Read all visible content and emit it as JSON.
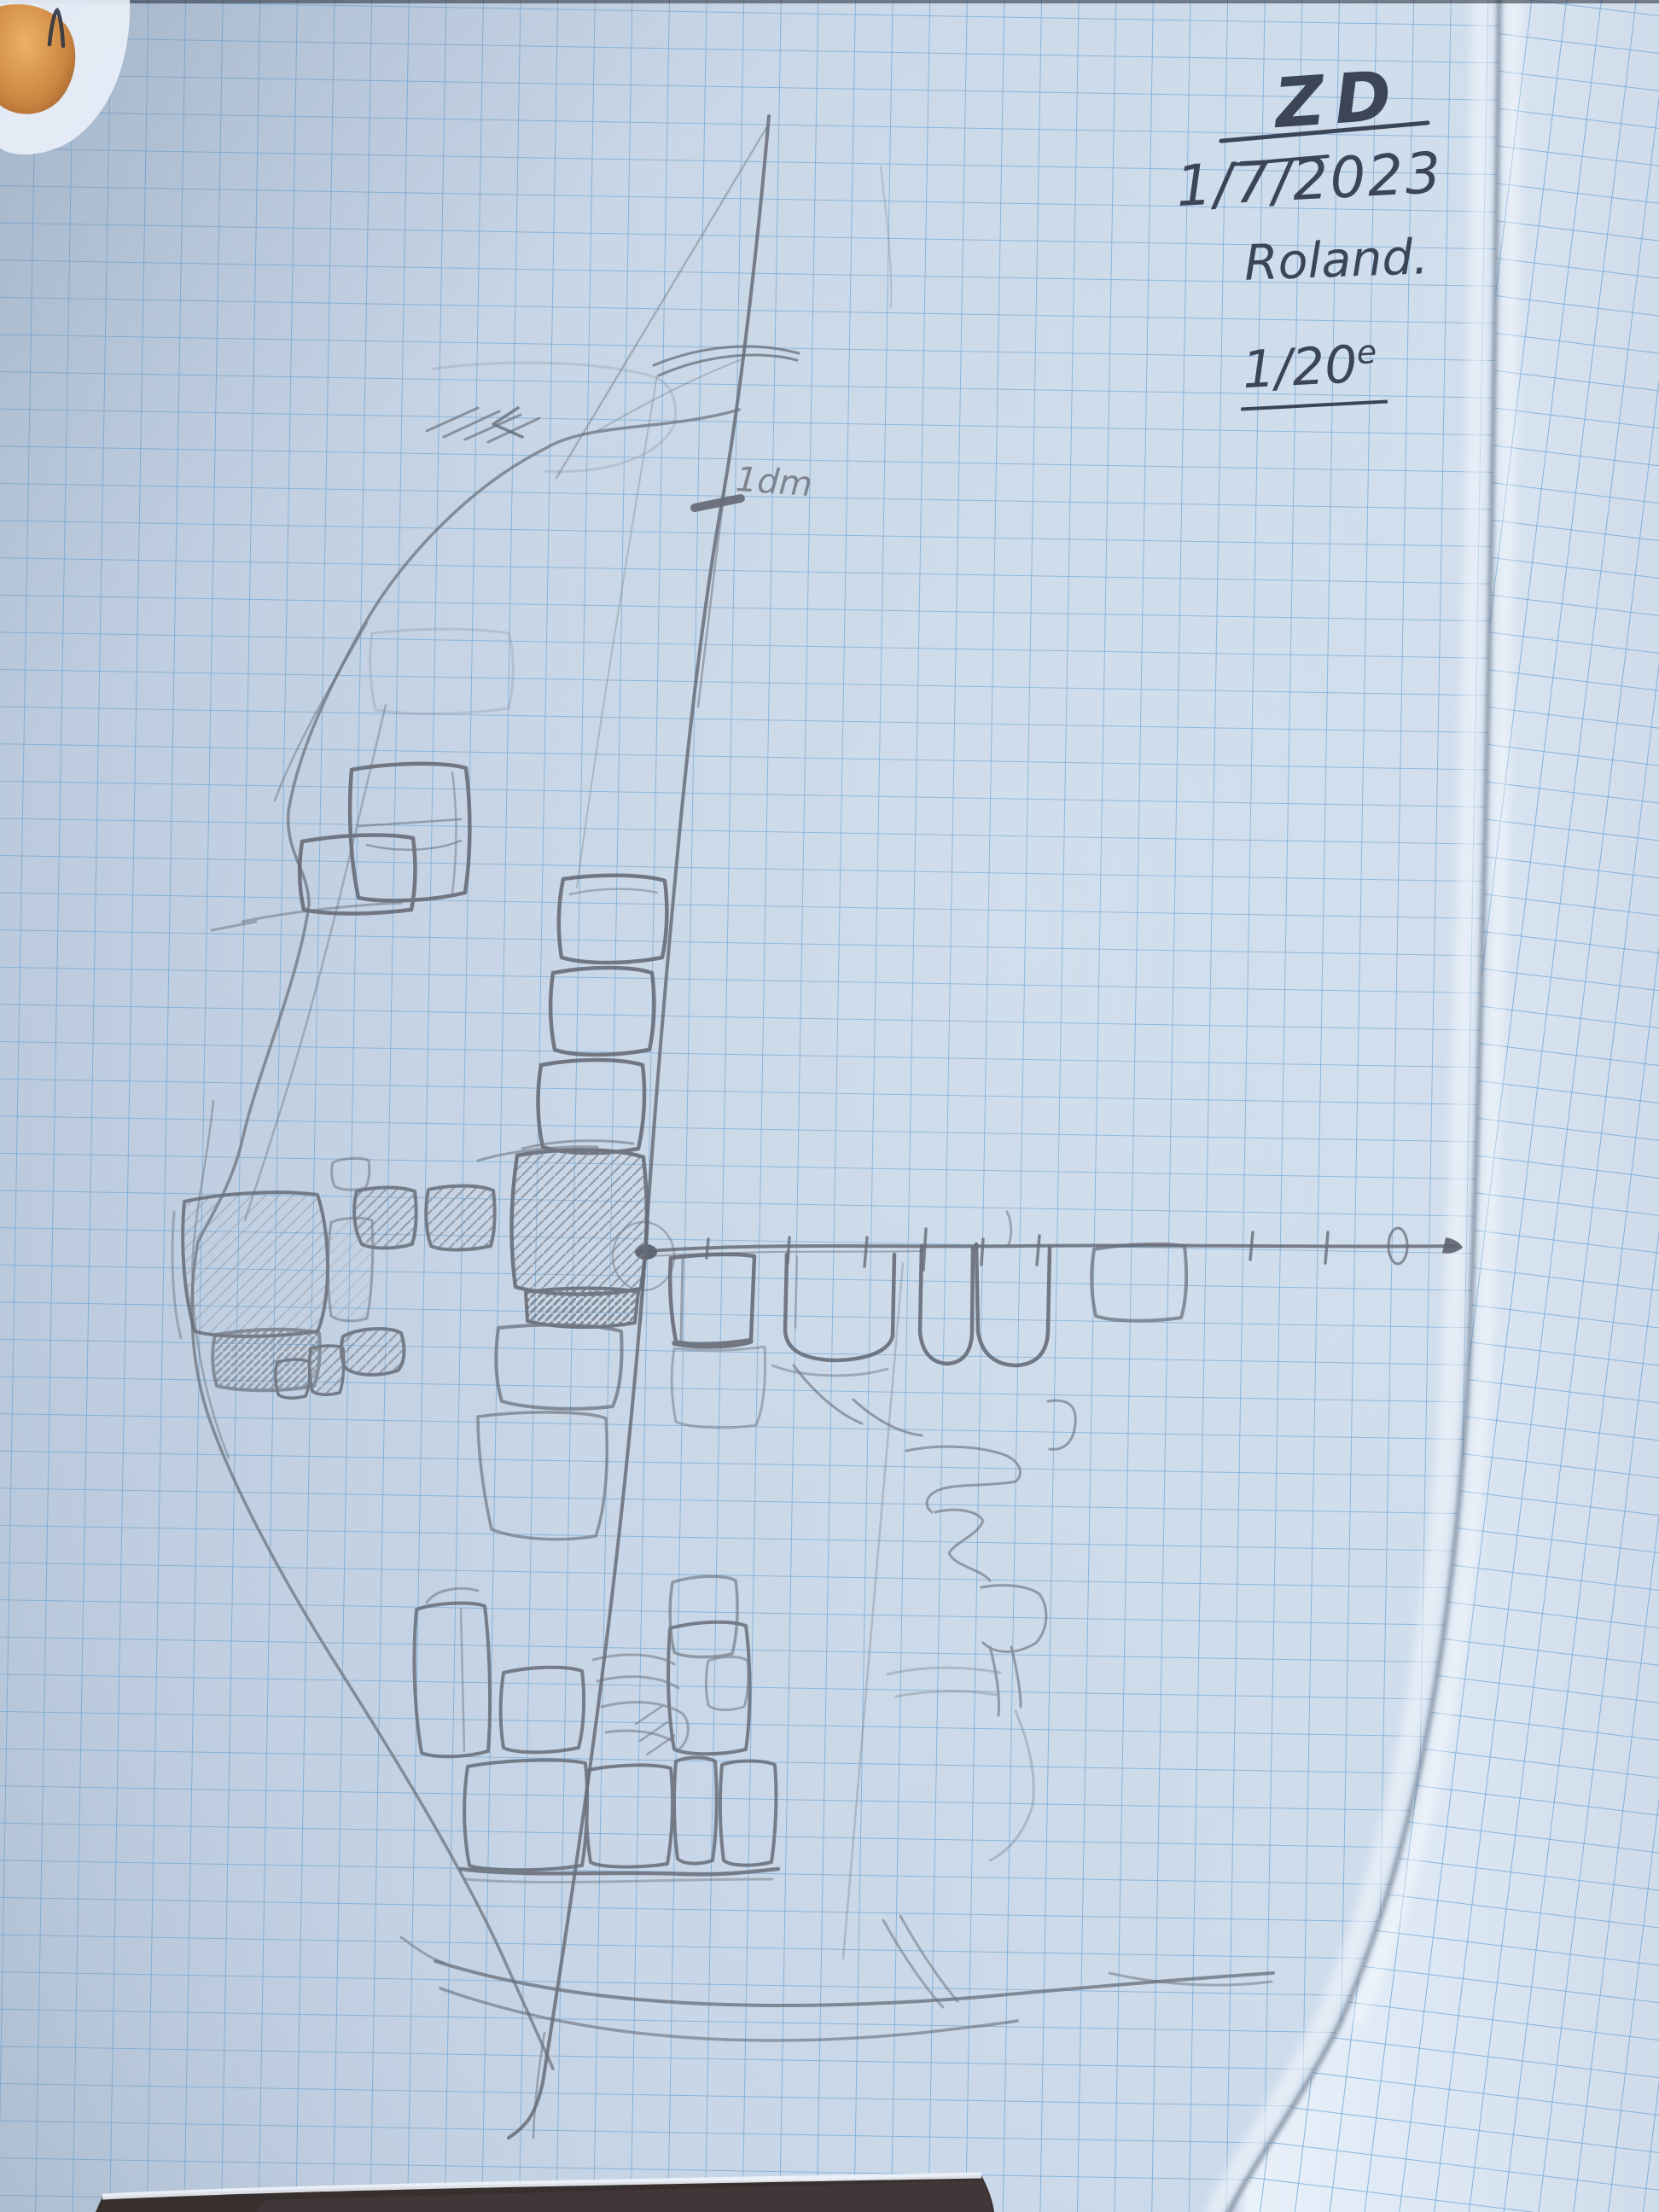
{
  "photo": {
    "subject": "pencil field sketch of a stone wall section drawn on squared (graph) notebook paper",
    "colors": {
      "paper": "#c6d4e5",
      "grid_blue": "#6ba2d2",
      "pencil_grey": "#6a707b",
      "pen_ink": "#3b4557",
      "fold_highlight": "#e9f0fa",
      "table_dark": "#38302e",
      "finger_orange": "#d0853f"
    }
  },
  "annotations": {
    "mark": "ZD",
    "date": "1/7/2023",
    "author": "Roland.",
    "scale": {
      "value": "1/20",
      "sup": "e"
    },
    "tick_label": "1dm"
  }
}
